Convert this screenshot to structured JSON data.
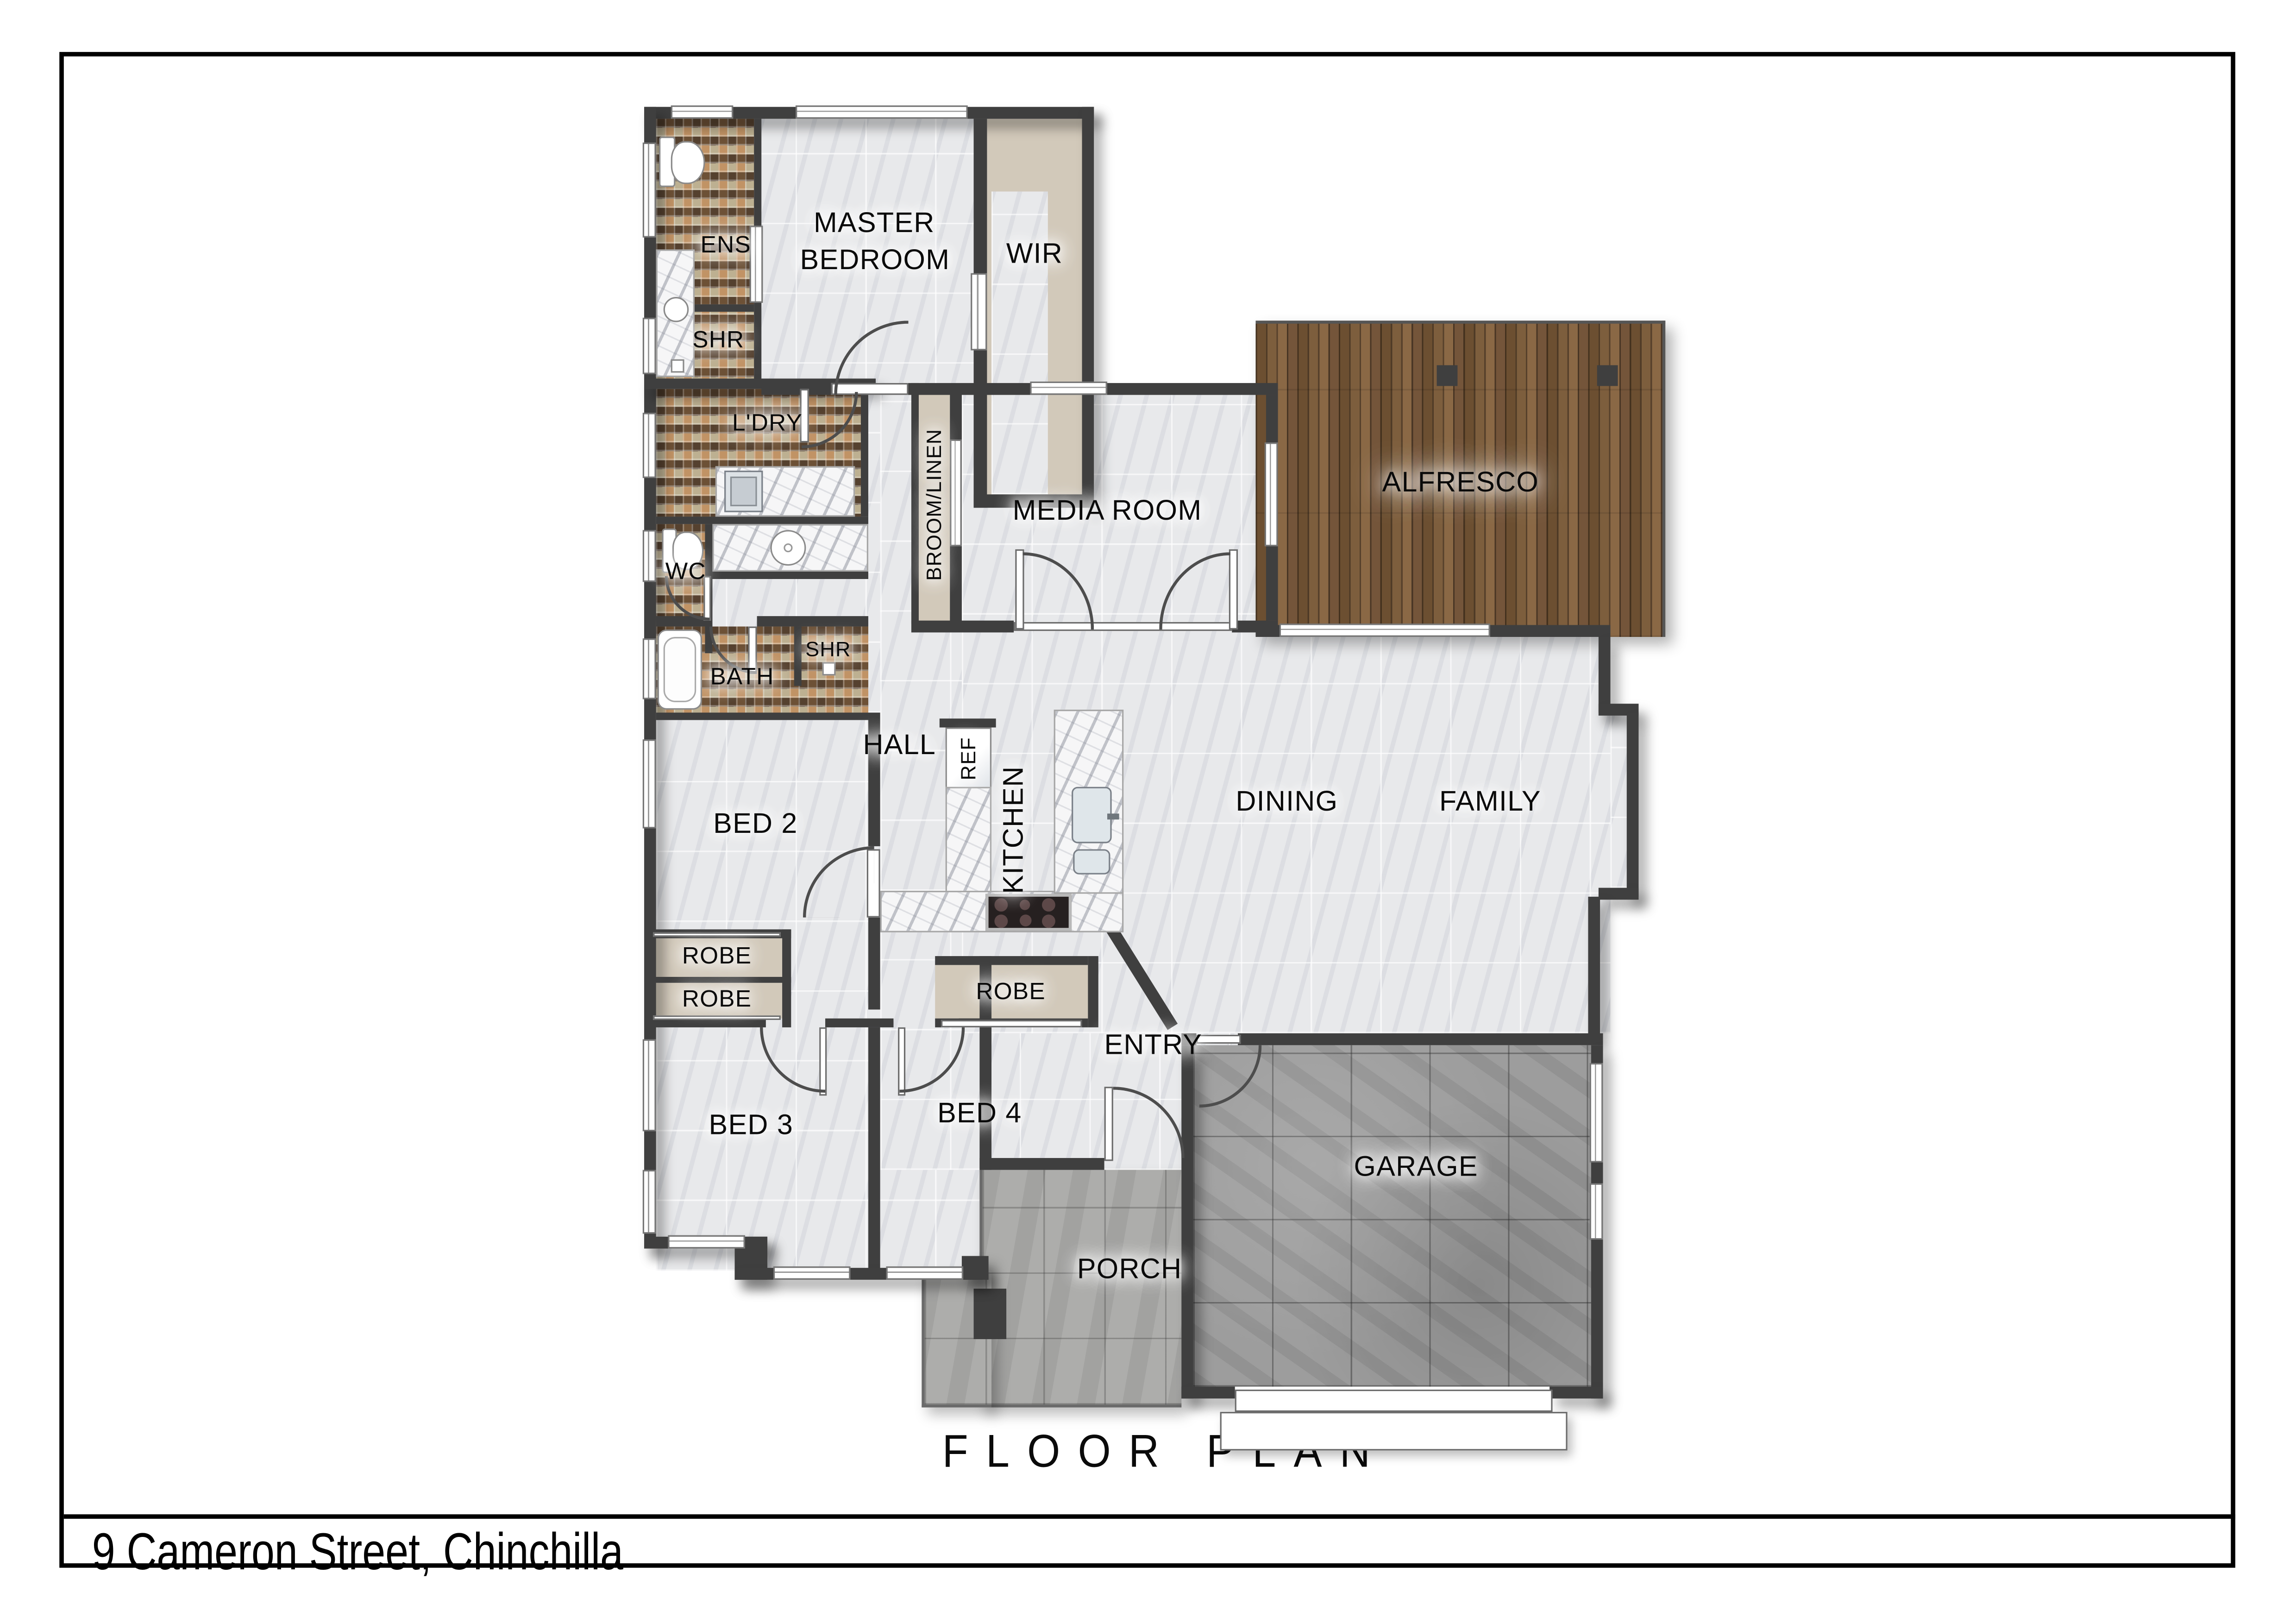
{
  "title": "FLOOR PLAN",
  "address": "9 Cameron Street, Chinchilla",
  "rooms": {
    "ens": "ENS",
    "shr_ens": "SHR",
    "master": "MASTER BEDROOM",
    "wir": "WIR",
    "ldry": "L'DRY",
    "wc": "WC",
    "broom": "BROOM/LINEN",
    "media": "MEDIA ROOM",
    "alfresco": "ALFRESCO",
    "bath": "BATH",
    "shr_bath": "SHR",
    "hall": "HALL",
    "ref": "REF",
    "kitchen": "KITCHEN",
    "bed2": "BED 2",
    "dining": "DINING",
    "family": "FAMILY",
    "robe1": "ROBE",
    "robe2": "ROBE",
    "robe3": "ROBE",
    "entry": "ENTRY",
    "bed3": "BED 3",
    "bed4": "BED 4",
    "garage": "GARAGE",
    "porch": "PORCH"
  },
  "colors": {
    "wall": "#3F3F3F",
    "marble_floor": "#E8E9EB",
    "mosaic_tile": "#8F7A60",
    "timber_deck": "#7A5B3B",
    "concrete": "#9A9A9A",
    "cabinetry": "#D2C9BA"
  }
}
